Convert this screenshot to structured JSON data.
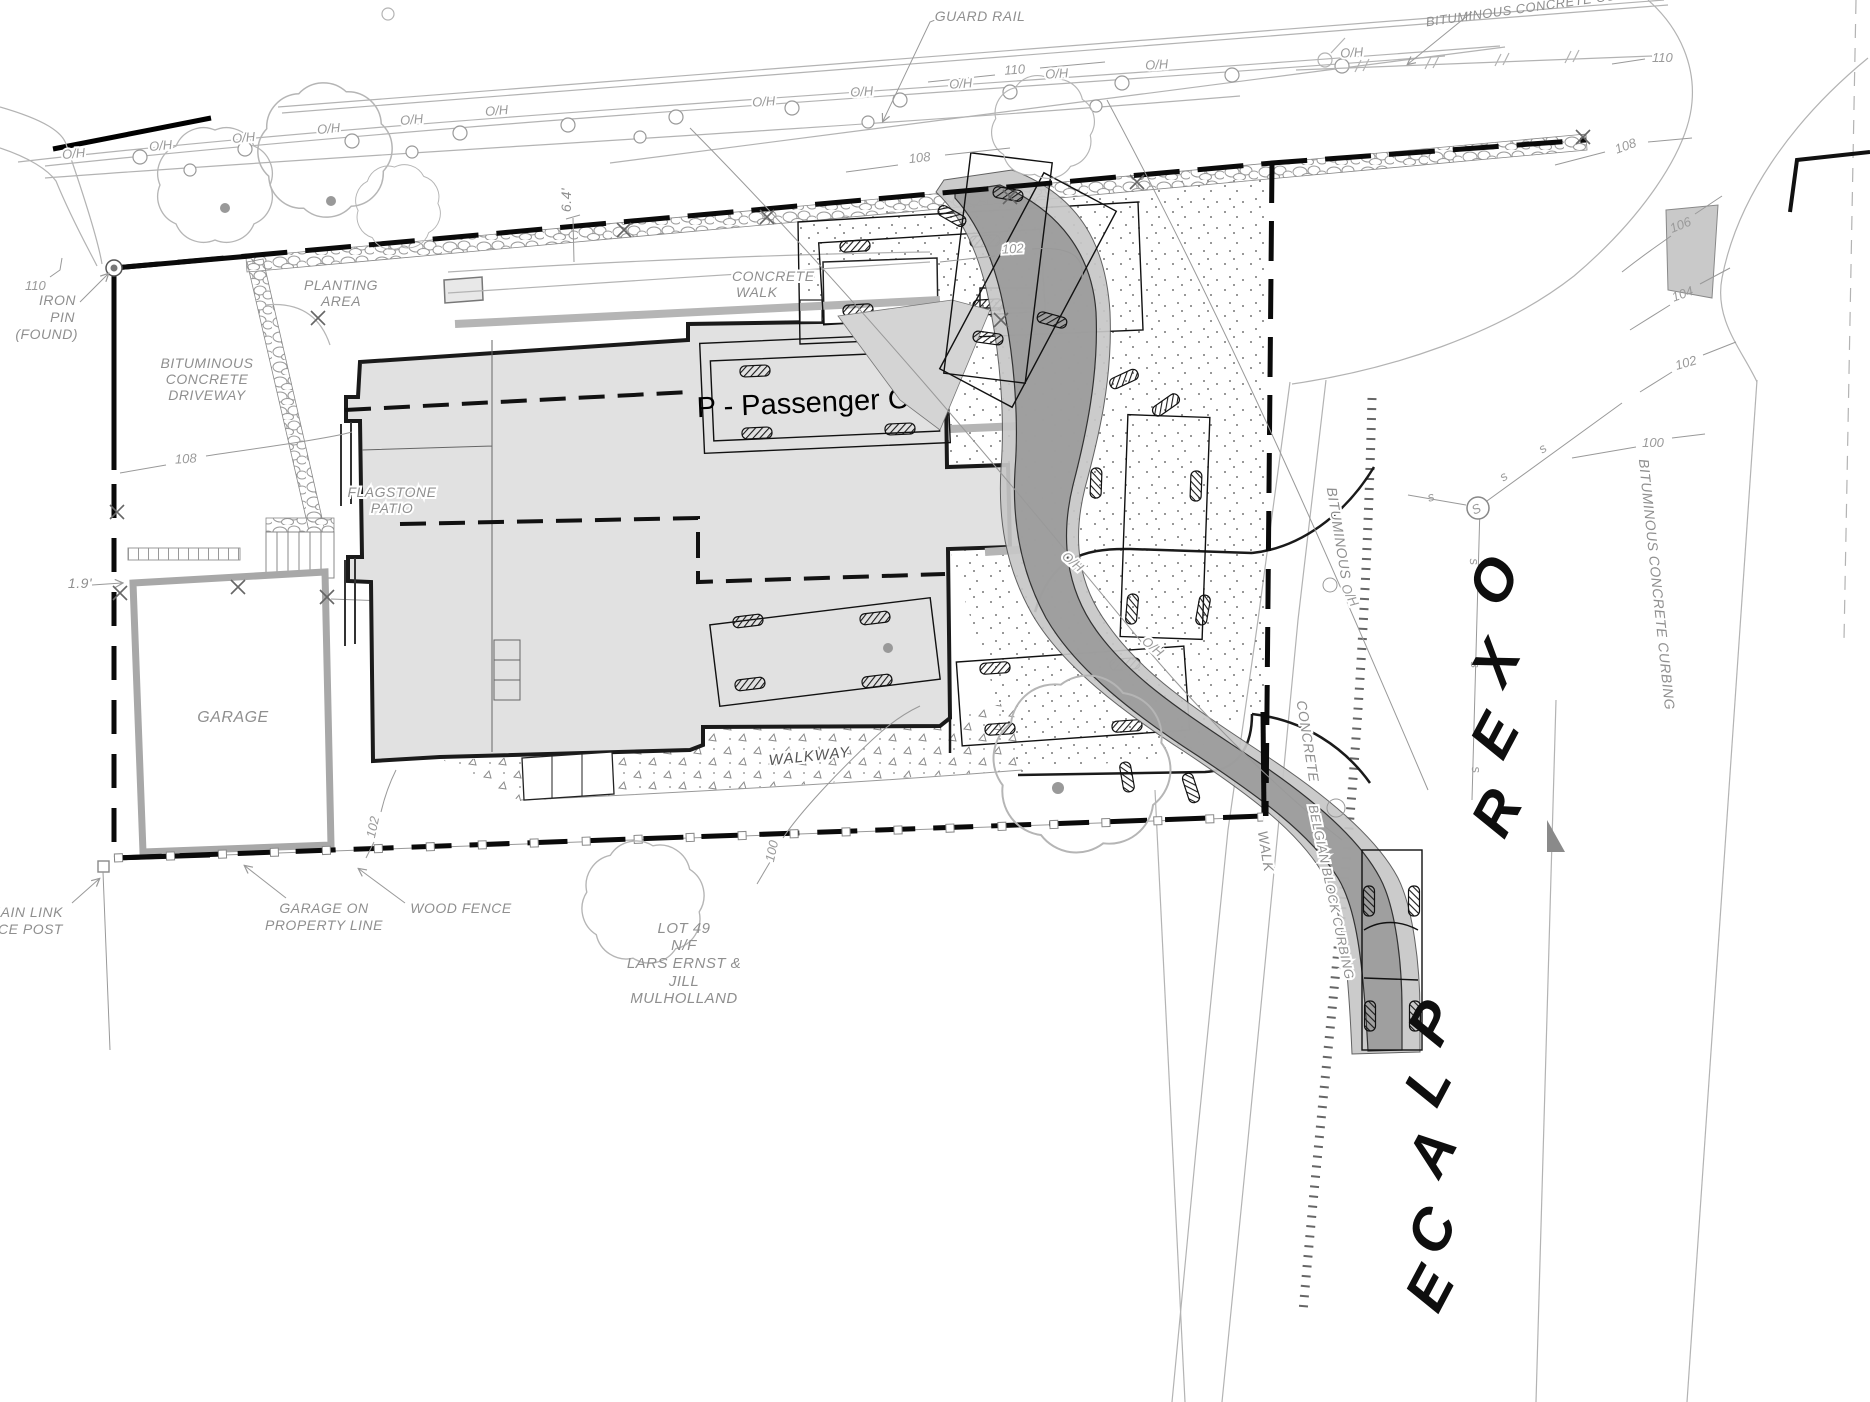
{
  "colors": {
    "house_fill": "#e1e1e1",
    "swath_core": "#9b9b9b",
    "swath_envelope": "#c7c7c7",
    "label_gray": "#8f8f8f",
    "line_gray": "#b3b3b3",
    "boundary_black": "#0a0a0a"
  },
  "street": {
    "name": "OXER PLACE",
    "letters": [
      "O",
      "X",
      "E",
      "R",
      "P",
      "L",
      "A",
      "C",
      "E"
    ]
  },
  "labels": {
    "guard_rail": "GUARD RAIL",
    "curbing_top": "BITUMINOUS CONCRETE CURBING",
    "curbing_right": "BITUMINOUS CONCRETE CURBING",
    "oh": "O/H",
    "iron1": "IRON",
    "iron2": "PIN",
    "iron3": "(FOUND)",
    "drv1": "BITUMINOUS",
    "drv2": "CONCRETE",
    "drv3": "DRIVEWAY",
    "plant1": "PLANTING",
    "plant2": "AREA",
    "cwalk1": "CONCRETE",
    "cwalk2": "WALK",
    "flag1": "FLAGSTONE",
    "flag2": "PATIO",
    "garage": "GARAGE",
    "vehicle": "P - Passenger Car",
    "walkway": "WALKWAY",
    "gar_on1": "GARAGE ON",
    "gar_on2": "PROPERTY LINE",
    "wood_fence": "WOOD FENCE",
    "chain1": "CHAIN LINK",
    "chain2": "FENCE POST",
    "lot1": "LOT 49",
    "lot2": "N/F",
    "lot3": "LARS ERNST &",
    "lot4": "JILL",
    "lot5": "MULHOLLAND",
    "st_bit": "BITUMINOUS",
    "st_conc": "CONCRETE",
    "st_walk": "WALK",
    "st_belgian": "BELGIAN BLOCK CURBING",
    "s_big": "S",
    "s_small": "s",
    "dim19": "1.9'",
    "dim64": "6.4'"
  },
  "contours": {
    "c110": "110",
    "c108": "108",
    "c106": "106",
    "c104": "104",
    "c102": "102",
    "c100": "100"
  }
}
